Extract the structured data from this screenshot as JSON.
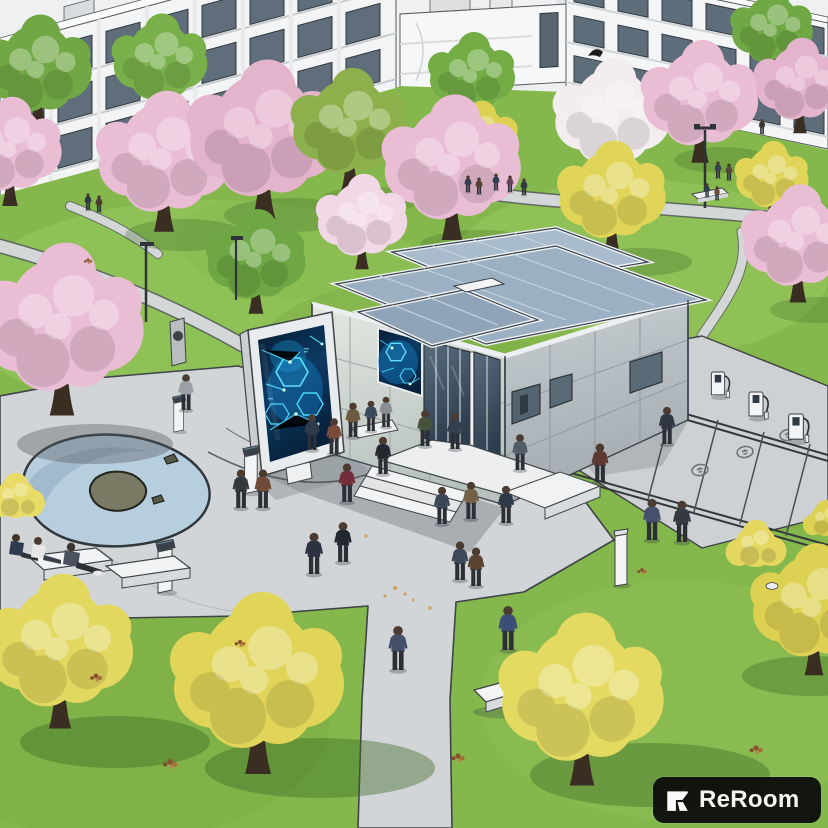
{
  "watermark": {
    "label": "ReRoom"
  },
  "palette": {
    "grass": "#84b84c",
    "pavement": "#d2d5d7",
    "water": "#b7cedf",
    "roof_steel_blue": "#9cb0c4",
    "wall_sunlit": "#dfe5df",
    "wall_shaded": "#a9b1b6",
    "glass": "#3f5264",
    "screen_background": "#082947",
    "screen_glow_cyan": "#49d8ff",
    "blossom_pink": "#e9bdd4",
    "foliage_yellow": "#e0d559",
    "foliage_green": "#6fa844",
    "sketch_outline": "#3f4447",
    "badge_background": "#0b0b0b",
    "badge_text": "#f5f5f5"
  },
  "scene": {
    "setting_label": "campus-plaza-rendering",
    "landmarks": [
      "sketch campus buildings",
      "cherry blossom trees",
      "yellow spring trees",
      "smart pavilion with digital displays",
      "freestanding media screen",
      "glass entrance",
      "plaza walkways",
      "organic pond",
      "info kiosks",
      "ev charging stalls",
      "benches",
      "pedestrians"
    ]
  }
}
